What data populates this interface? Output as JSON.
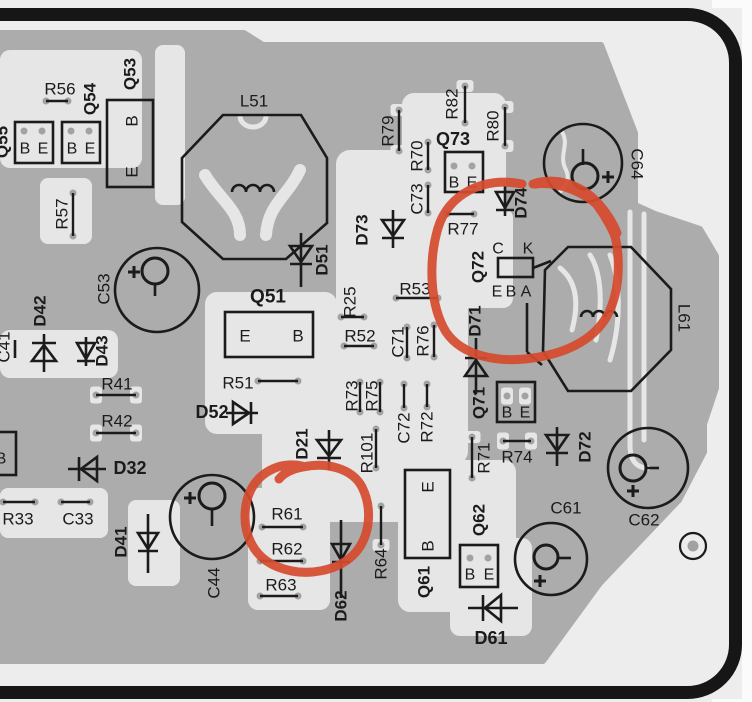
{
  "title": "PCB component layout diagram with red marker annotations",
  "colors": {
    "background": "#ededed",
    "page_white": "#fbfbfb",
    "copper": "#acacac",
    "substrate": "#e6e6e6",
    "pad_dot": "#a2a2a2",
    "ink": "#1b1b1b",
    "frame": "#161616",
    "annotation": "#d54b2f"
  },
  "diagram": {
    "pour": "0,33 244,33 263,45 601,45 635,133 635,205 655,214 700,229 716,256 716,388 704,424 704,452 679,500 600,583 543,661 0,661",
    "lightRegions": [
      [
        0,
        50,
        142,
        118,
        10
      ],
      [
        155,
        45,
        30,
        160,
        8
      ],
      [
        40,
        178,
        52,
        66,
        8
      ],
      [
        205,
        292,
        132,
        142,
        12
      ],
      [
        336,
        150,
        132,
        315,
        14
      ],
      [
        262,
        420,
        148,
        102,
        12
      ],
      [
        248,
        488,
        82,
        122,
        10
      ],
      [
        398,
        460,
        118,
        152,
        12
      ],
      [
        450,
        538,
        82,
        98,
        10
      ],
      [
        402,
        93,
        104,
        122,
        12
      ],
      [
        0,
        330,
        118,
        48,
        10
      ],
      [
        0,
        488,
        108,
        50,
        8
      ],
      [
        128,
        500,
        52,
        86,
        8
      ],
      [
        438,
        208,
        75,
        100,
        10
      ]
    ],
    "lightPaths": [
      {
        "d": "M630,212 L630,445",
        "w": 5
      },
      {
        "d": "M644,214 L644,440",
        "w": 5
      },
      {
        "d": "M630,445 C630,460 636,468 648,468",
        "w": 5
      },
      {
        "d": "M560,268 C575,280 580,300 572,330",
        "w": 5
      },
      {
        "d": "M590,255 C600,270 604,300 596,340",
        "w": 5
      },
      {
        "d": "M610,255 C620,280 622,320 610,360",
        "w": 5
      },
      {
        "d": "M562,132 C570,145 558,155 566,170 C570,178 566,186 560,192",
        "w": 4
      },
      {
        "d": "M240,116 a13,11 0 0 0 26,0",
        "w": 5
      },
      {
        "d": "M205,175 C220,200 240,210 240,235",
        "w": 12
      },
      {
        "d": "M300,170 C288,196 268,204 266,235",
        "w": 12
      }
    ],
    "leads": [
      [
        46,
        101,
        68,
        101
      ],
      [
        73,
        193,
        73,
        236
      ],
      [
        258,
        381,
        298,
        381
      ],
      [
        341,
        317,
        364,
        317
      ],
      [
        344,
        346,
        374,
        346
      ],
      [
        396,
        298,
        438,
        298
      ],
      [
        407,
        327,
        407,
        358
      ],
      [
        434,
        325,
        434,
        357
      ],
      [
        360,
        382,
        360,
        412
      ],
      [
        380,
        382,
        380,
        412
      ],
      [
        404,
        384,
        404,
        408
      ],
      [
        427,
        384,
        427,
        407
      ],
      [
        447,
        214,
        474,
        214
      ],
      [
        428,
        185,
        428,
        213
      ],
      [
        428,
        142,
        428,
        170
      ],
      [
        399,
        110,
        399,
        151
      ],
      [
        465,
        86,
        465,
        123
      ],
      [
        505,
        107,
        505,
        146
      ],
      [
        472,
        437,
        472,
        478
      ],
      [
        503,
        441,
        531,
        441
      ],
      [
        381,
        506,
        381,
        545
      ],
      [
        376,
        429,
        376,
        468
      ],
      [
        262,
        527,
        303,
        527
      ],
      [
        260,
        561,
        303,
        561
      ],
      [
        260,
        596,
        298,
        596
      ],
      [
        3,
        502,
        35,
        502
      ],
      [
        61,
        502,
        90,
        502
      ],
      [
        96,
        395,
        136,
        395
      ],
      [
        96,
        433,
        136,
        433
      ]
    ],
    "extraPads": [
      {
        "x": 24,
        "y": 131
      },
      {
        "x": 42,
        "y": 131
      },
      {
        "x": 71,
        "y": 131
      },
      {
        "x": 89,
        "y": 131
      },
      {
        "x": 454,
        "y": 166
      },
      {
        "x": 472,
        "y": 166
      },
      {
        "x": 507,
        "y": 396
      },
      {
        "x": 525,
        "y": 396
      },
      {
        "x": 470,
        "y": 558
      },
      {
        "x": 488,
        "y": 558
      }
    ],
    "wires": [
      [
        533,
        268,
        551,
        261
      ],
      [
        527,
        303,
        527,
        352
      ],
      [
        527,
        352,
        542,
        365
      ],
      [
        583,
        149,
        583,
        165
      ],
      [
        155,
        285,
        155,
        296
      ],
      [
        212,
        510,
        212,
        526
      ],
      [
        646,
        468,
        659,
        468
      ],
      [
        558,
        558,
        571,
        558
      ],
      [
        15,
        340,
        15,
        358
      ]
    ],
    "boxes": [
      [
        15,
        122,
        38,
        41
      ],
      [
        62,
        122,
        38,
        41
      ],
      [
        107,
        100,
        46,
        87
      ],
      [
        225,
        312,
        88,
        45
      ],
      [
        445,
        152,
        38,
        40
      ],
      [
        498,
        258,
        35,
        19
      ],
      [
        497,
        382,
        38,
        40
      ],
      [
        460,
        545,
        38,
        42
      ],
      [
        405,
        470,
        45,
        88
      ],
      [
        -16,
        432,
        32,
        43
      ]
    ],
    "octagons": [
      "182,158 223,115 301,115 327,158 327,223 286,259 223,259 182,222",
      "545,270 568,247 631,247 671,289 671,350 631,391 568,391 543,351"
    ],
    "coils": [
      {
        "x": 232,
        "y": 192,
        "n": 3,
        "r": 7
      },
      {
        "x": 581,
        "y": 317,
        "n": 3,
        "r": 6
      }
    ],
    "diodes": [
      {
        "n": "D51",
        "x": 301,
        "y": 254,
        "dir": "down",
        "s": 11,
        "l1": 233,
        "l2": 287
      },
      {
        "n": "D73",
        "x": 393,
        "y": 228,
        "dir": "down",
        "s": 11,
        "l1": 210,
        "l2": 248
      },
      {
        "n": "D74",
        "x": 505,
        "y": 200,
        "dir": "down",
        "s": 9,
        "l1": 186,
        "l2": 216
      },
      {
        "n": "D71",
        "x": 476,
        "y": 368,
        "dir": "up",
        "s": 11,
        "l1": 338,
        "l2": 394
      },
      {
        "n": "D21",
        "x": 329,
        "y": 448,
        "dir": "down",
        "s": 12,
        "l1": 430,
        "l2": 470
      },
      {
        "n": "D62",
        "x": 341,
        "y": 552,
        "dir": "down",
        "s": 9,
        "l1": 520,
        "l2": 598
      },
      {
        "n": "D61",
        "x": 493,
        "y": 608,
        "dir": "left",
        "s": 13,
        "l1": 468,
        "l2": 518
      },
      {
        "n": "D32",
        "x": 89,
        "y": 469,
        "dir": "left",
        "s": 12,
        "l1": 68,
        "l2": 106
      },
      {
        "n": "D41",
        "x": 148,
        "y": 541,
        "dir": "down",
        "s": 10,
        "l1": 514,
        "l2": 573
      },
      {
        "n": "D42",
        "x": 44,
        "y": 353,
        "dir": "up",
        "s": 12,
        "l1": 334,
        "l2": 372
      },
      {
        "n": "D43",
        "x": 86,
        "y": 351,
        "dir": "down",
        "s": 9,
        "l1": 337,
        "l2": 366
      },
      {
        "n": "D52",
        "x": 241,
        "y": 413,
        "dir": "right",
        "s": 11,
        "l1": 226,
        "l2": 258
      },
      {
        "n": "D72",
        "x": 557,
        "y": 443,
        "dir": "down",
        "s": 11,
        "l1": 427,
        "l2": 466
      }
    ],
    "caps": [
      {
        "n": "C64",
        "cx": 583,
        "cy": 163,
        "r": 39,
        "icx": 585,
        "icy": 176,
        "ir": 13,
        "px": 608,
        "py": 177
      },
      {
        "n": "C53",
        "cx": 157,
        "cy": 290,
        "r": 42,
        "icx": 155,
        "icy": 271,
        "ir": 13,
        "px": 134,
        "py": 272
      },
      {
        "n": "C44",
        "cx": 212,
        "cy": 517,
        "r": 42,
        "icx": 212,
        "icy": 496,
        "ir": 13,
        "px": 190,
        "py": 498
      },
      {
        "n": "C62",
        "cx": 648,
        "cy": 468,
        "r": 40,
        "icx": 633,
        "icy": 468,
        "ir": 13,
        "px": 633,
        "py": 491
      },
      {
        "n": "C61",
        "cx": 551,
        "cy": 559,
        "r": 36,
        "icx": 546,
        "icy": 557,
        "ir": 12,
        "px": 540,
        "py": 581
      }
    ],
    "hole": {
      "cx": 693,
      "cy": 546,
      "r": 13,
      "ir": 5.5
    },
    "labels": [
      {
        "t": "Q55",
        "x": 2,
        "y": 142,
        "r": -90,
        "b": 1
      },
      {
        "t": "R56",
        "x": 60,
        "y": 89
      },
      {
        "t": "Q54",
        "x": 90,
        "y": 99,
        "r": -90,
        "b": 1
      },
      {
        "t": "Q53",
        "x": 130,
        "y": 74,
        "r": -90,
        "b": 1
      },
      {
        "t": "R57",
        "x": 62,
        "y": 214,
        "r": -90
      },
      {
        "t": "L51",
        "x": 254,
        "y": 101
      },
      {
        "t": "D51",
        "x": 322,
        "y": 260,
        "r": -90,
        "b": 1
      },
      {
        "t": "Q51",
        "x": 268,
        "y": 297,
        "b": 1,
        "fs": 19
      },
      {
        "t": "R51",
        "x": 238,
        "y": 383
      },
      {
        "t": "D52",
        "x": 212,
        "y": 412,
        "b": 1,
        "fs": 18
      },
      {
        "t": "R25",
        "x": 350,
        "y": 302,
        "r": -90
      },
      {
        "t": "R52",
        "x": 360,
        "y": 336
      },
      {
        "t": "R53",
        "x": 415,
        "y": 289
      },
      {
        "t": "C71",
        "x": 398,
        "y": 342,
        "r": -90
      },
      {
        "t": "R76",
        "x": 423,
        "y": 341,
        "r": -90
      },
      {
        "t": "R73",
        "x": 352,
        "y": 396,
        "r": -90
      },
      {
        "t": "R75",
        "x": 372,
        "y": 396,
        "r": -90
      },
      {
        "t": "C72",
        "x": 404,
        "y": 428,
        "r": -90
      },
      {
        "t": "R72",
        "x": 427,
        "y": 427,
        "r": -90
      },
      {
        "t": "D73",
        "x": 362,
        "y": 230,
        "r": -90,
        "b": 1
      },
      {
        "t": "R77",
        "x": 463,
        "y": 229
      },
      {
        "t": "C73",
        "x": 417,
        "y": 199,
        "r": -90
      },
      {
        "t": "R70",
        "x": 417,
        "y": 156,
        "r": -90
      },
      {
        "t": "R79",
        "x": 388,
        "y": 131,
        "r": -90
      },
      {
        "t": "R82",
        "x": 452,
        "y": 104,
        "r": -90
      },
      {
        "t": "R80",
        "x": 493,
        "y": 126,
        "r": -90
      },
      {
        "t": "Q73",
        "x": 453,
        "y": 139,
        "b": 1,
        "fs": 18
      },
      {
        "t": "D74",
        "x": 521,
        "y": 203,
        "r": -90,
        "b": 1
      },
      {
        "t": "C64",
        "x": 637,
        "y": 164,
        "r": 90
      },
      {
        "t": "C",
        "x": 498,
        "y": 249,
        "fs": 16
      },
      {
        "t": "K",
        "x": 528,
        "y": 249,
        "fs": 16
      },
      {
        "t": "E",
        "x": 497,
        "y": 292,
        "fs": 16
      },
      {
        "t": "B",
        "x": 511,
        "y": 292,
        "fs": 16
      },
      {
        "t": "A",
        "x": 526,
        "y": 292,
        "fs": 16
      },
      {
        "t": "Q72",
        "x": 478,
        "y": 267,
        "r": -90,
        "b": 1
      },
      {
        "t": "D71",
        "x": 475,
        "y": 321,
        "r": -90,
        "b": 1
      },
      {
        "t": "L61",
        "x": 684,
        "y": 318,
        "r": 90
      },
      {
        "t": "Q71",
        "x": 479,
        "y": 403,
        "r": -90,
        "b": 1
      },
      {
        "t": "R71",
        "x": 484,
        "y": 458,
        "r": -90
      },
      {
        "t": "R74",
        "x": 517,
        "y": 457
      },
      {
        "t": "D72",
        "x": 585,
        "y": 447,
        "r": -90,
        "b": 1
      },
      {
        "t": "C62",
        "x": 644,
        "y": 520
      },
      {
        "t": "C61",
        "x": 566,
        "y": 508
      },
      {
        "t": "Q62",
        "x": 479,
        "y": 520,
        "r": -90,
        "b": 1
      },
      {
        "t": "Q61",
        "x": 424,
        "y": 582,
        "r": -90,
        "b": 1
      },
      {
        "t": "D61",
        "x": 491,
        "y": 638,
        "b": 1,
        "fs": 18
      },
      {
        "t": "R64",
        "x": 381,
        "y": 564,
        "r": -90
      },
      {
        "t": "D62",
        "x": 341,
        "y": 606,
        "r": -90,
        "b": 1
      },
      {
        "t": "R61",
        "x": 287,
        "y": 514
      },
      {
        "t": "R62",
        "x": 287,
        "y": 549
      },
      {
        "t": "R63",
        "x": 281,
        "y": 585
      },
      {
        "t": "D21",
        "x": 302,
        "y": 444,
        "r": -90,
        "b": 1
      },
      {
        "t": "R101",
        "x": 367,
        "y": 453,
        "r": -90
      },
      {
        "t": "R33",
        "x": 18,
        "y": 519
      },
      {
        "t": "C33",
        "x": 78,
        "y": 519
      },
      {
        "t": "D32",
        "x": 130,
        "y": 468,
        "b": 1,
        "fs": 18
      },
      {
        "t": "D41",
        "x": 121,
        "y": 542,
        "r": -90,
        "b": 1
      },
      {
        "t": "C44",
        "x": 214,
        "y": 583,
        "r": -90
      },
      {
        "t": "D42",
        "x": 40,
        "y": 311,
        "r": -90,
        "b": 1
      },
      {
        "t": "D43",
        "x": 102,
        "y": 351,
        "r": -90,
        "b": 1
      },
      {
        "t": "C41",
        "x": 4,
        "y": 347,
        "r": -90
      },
      {
        "t": "R41",
        "x": 117,
        "y": 384
      },
      {
        "t": "R42",
        "x": 117,
        "y": 421
      },
      {
        "t": "C53",
        "x": 104,
        "y": 289,
        "r": -90
      },
      {
        "t": "B",
        "x": 25,
        "y": 149,
        "fs": 16
      },
      {
        "t": "E",
        "x": 43,
        "y": 149,
        "fs": 16
      },
      {
        "t": "B",
        "x": 72,
        "y": 149,
        "fs": 16
      },
      {
        "t": "E",
        "x": 90,
        "y": 149,
        "fs": 16
      },
      {
        "t": "B",
        "x": 132,
        "y": 121,
        "r": -90,
        "fs": 17
      },
      {
        "t": "E",
        "x": 132,
        "y": 172,
        "r": -90,
        "fs": 17
      },
      {
        "t": "E",
        "x": 245,
        "y": 336,
        "fs": 17
      },
      {
        "t": "B",
        "x": 298,
        "y": 336,
        "fs": 17
      },
      {
        "t": "B",
        "x": 454,
        "y": 183,
        "fs": 16
      },
      {
        "t": "E",
        "x": 472,
        "y": 183,
        "fs": 16
      },
      {
        "t": "B",
        "x": 507,
        "y": 413,
        "fs": 16
      },
      {
        "t": "E",
        "x": 525,
        "y": 413,
        "fs": 16
      },
      {
        "t": "B",
        "x": 470,
        "y": 575,
        "fs": 16
      },
      {
        "t": "E",
        "x": 489,
        "y": 575,
        "fs": 16
      },
      {
        "t": "E",
        "x": 428,
        "y": 487,
        "r": -90,
        "fs": 17
      },
      {
        "t": "B",
        "x": 428,
        "y": 546,
        "r": -90,
        "fs": 17
      },
      {
        "t": "B",
        "x": 1,
        "y": 459,
        "fs": 16
      }
    ],
    "annotations": [
      {
        "name": "marker-circle-q72-l61",
        "d": "M522,184 C484,176 448,194 438,228 C428,262 430,306 446,332 C463,357 500,363 533,358 C568,353 598,338 610,310 C622,282 621,240 607,216 C592,194 560,181 535,184"
      },
      {
        "name": "marker-tail-1",
        "d": "M533,184 C557,176 582,186 597,202 C606,212 613,223 617,233"
      },
      {
        "name": "marker-tail-2",
        "d": "M590,196 C600,208 609,222 615,236"
      },
      {
        "name": "marker-circle-r61-r62",
        "d": "M302,466 C278,461 254,474 247,500 C240,530 252,557 278,567 C306,578 340,571 356,552 C371,534 372,507 362,487 C352,468 326,462 303,467 C292,469 284,473 279,479"
      }
    ]
  }
}
